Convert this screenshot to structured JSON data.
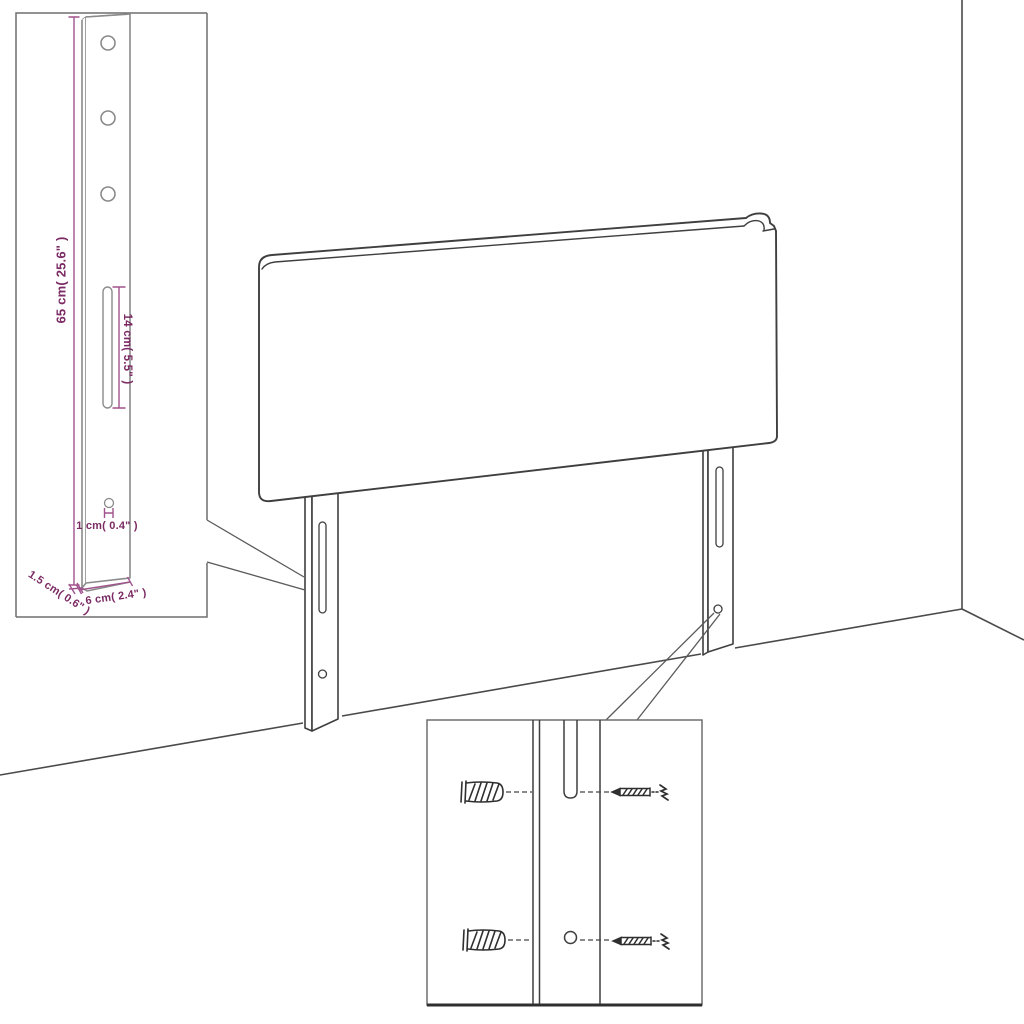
{
  "diagram": {
    "kind": "headboard-assembly-technical-drawing",
    "colors": {
      "main_line": "#3f3f3f",
      "inset_line": "#8a8a8a",
      "inset_border": "#6e6e6e",
      "dimension_line": "#a0538c",
      "dimension_text": "#7b2a63",
      "background": "#ffffff"
    },
    "leg_detail_inset": {
      "dim_height": "65 cm( 25.6\" )",
      "dim_slot": "14 cm( 5.5\" )",
      "dim_hole": "1 cm( 0.4\" )",
      "dim_depth": "1.5 cm( 0.6\" )",
      "dim_width": "6 cm( 2.4\" )"
    },
    "mounting_detail_inset": {
      "parts": [
        "wall-plug",
        "wall-plug",
        "screw",
        "screw"
      ]
    },
    "scene": {
      "objects": [
        "headboard-panel",
        "left-mounting-leg",
        "right-mounting-leg",
        "room-corner",
        "floor"
      ]
    }
  }
}
